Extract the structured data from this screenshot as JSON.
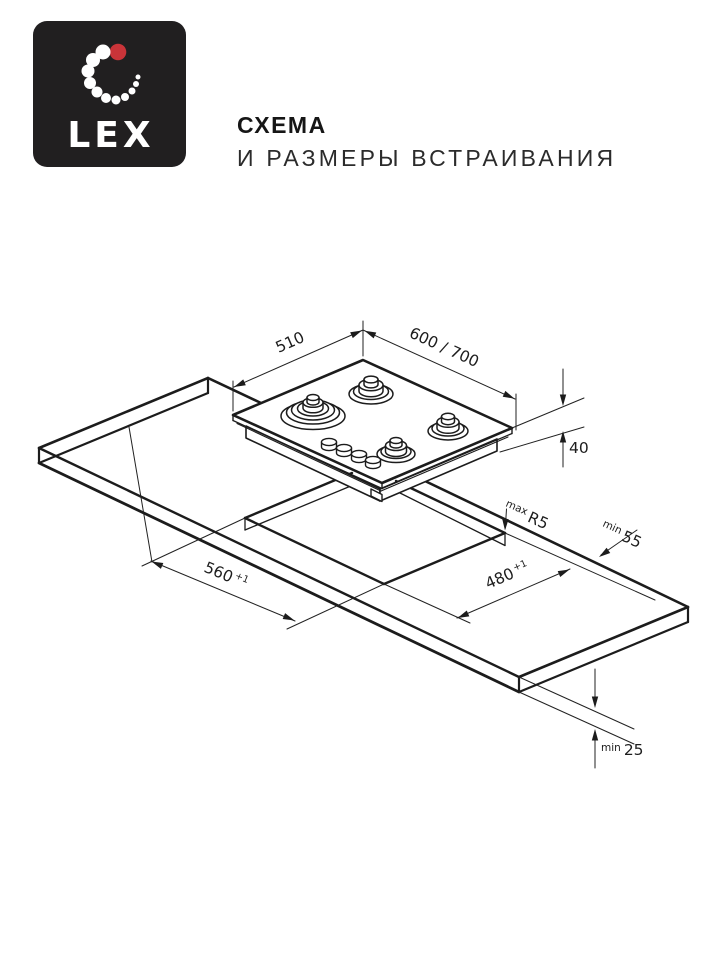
{
  "brand": {
    "logo_text": "LEX"
  },
  "header": {
    "title_line1": "СХЕМА",
    "title_line2": "И РАЗМЕРЫ ВСТРАИВАНИЯ"
  },
  "colors": {
    "logo_bg": "#211f20",
    "accent_red": "#ca3439",
    "line": "#1c1c1c"
  },
  "diagram": {
    "hob": {
      "depth_label": "510",
      "width_label": "600 / 700",
      "height_label": "40"
    },
    "cutout": {
      "width_label": "560",
      "width_tolerance": "+1",
      "depth_label": "480",
      "depth_tolerance": "+1",
      "corner_radius_qualifier": "max",
      "corner_radius_label": "R5"
    },
    "clearances": {
      "rear_qualifier": "min",
      "rear_label": "55",
      "bottom_qualifier": "min",
      "bottom_label": "25"
    }
  }
}
